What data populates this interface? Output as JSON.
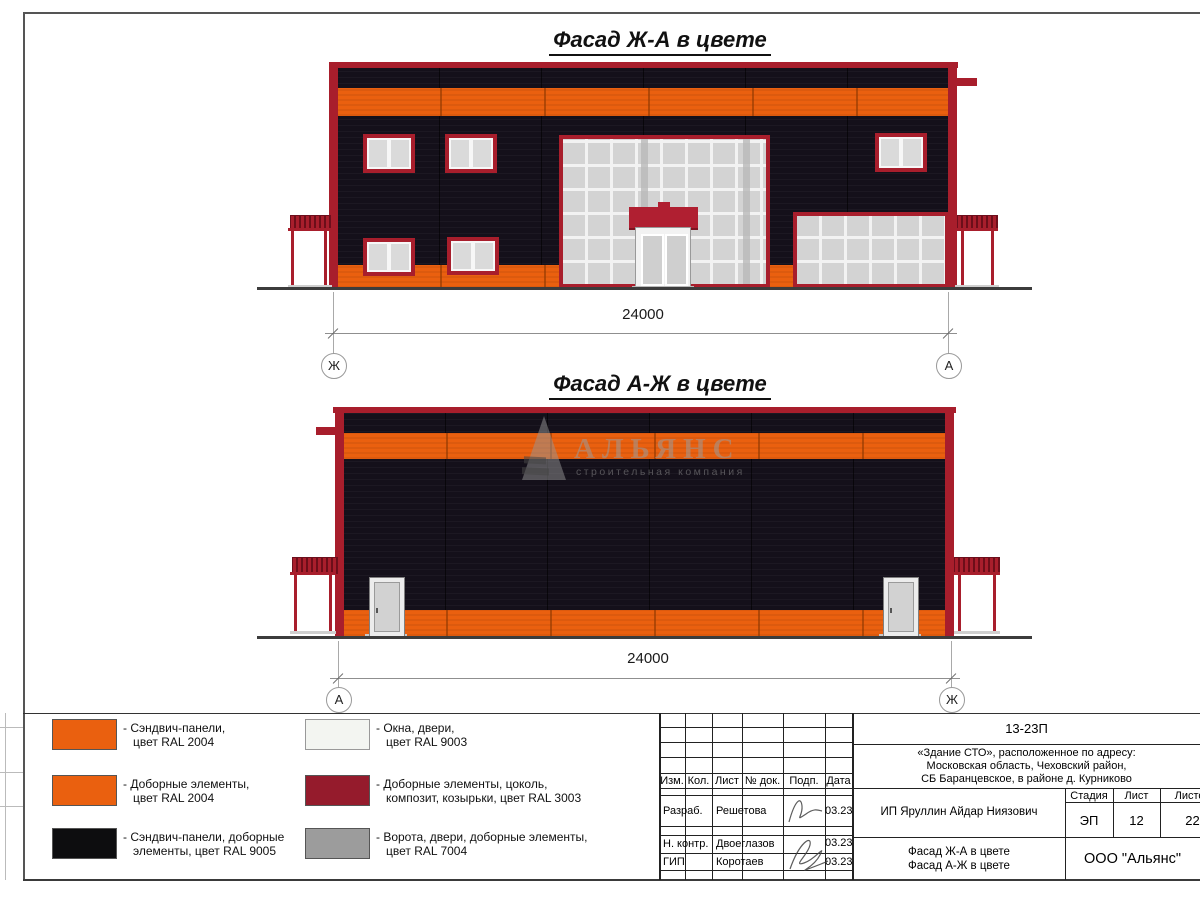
{
  "colors": {
    "orange": "#EA600F",
    "red": "#A81E2C",
    "canopyred": "#B01F31",
    "black": "#14101A",
    "glass": "#D3D3D3",
    "doorgray": "#D2D2D2",
    "ground": "#3C3C3C"
  },
  "facade1": {
    "title": "Фасад Ж-А в цвете",
    "dim": "24000",
    "axis_left": "Ж",
    "axis_right": "А"
  },
  "facade2": {
    "title": "Фасад А-Ж в цвете",
    "dim": "24000",
    "axis_left": "А",
    "axis_right": "Ж"
  },
  "watermark": {
    "brand": "АЛЬЯНС",
    "tagline": "строительная компания"
  },
  "legend": {
    "items": [
      {
        "color": "#EA600F",
        "line1": "- Сэндвич-панели,",
        "line2": "цвет RAL 2004"
      },
      {
        "color": "#EA600F",
        "line1": "- Доборные элементы,",
        "line2": "цвет RAL 2004"
      },
      {
        "color": "#0D0D0F",
        "line1": "- Сэндвич-панели, доборные",
        "line2": "элементы, цвет RAL 9005"
      },
      {
        "color": "#F3F5F1",
        "line1": "- Окна, двери,",
        "line2": "цвет RAL 9003"
      },
      {
        "color": "#951B2C",
        "line1": "- Доборные элементы, цоколь,",
        "line2": "композит, козырьки, цвет RAL 3003"
      },
      {
        "color": "#9C9C9C",
        "line1": "- Ворота, двери, доборные элементы,",
        "line2": "цвет RAL 7004"
      }
    ]
  },
  "titleblock": {
    "doc_number": "13-23П",
    "address1": "«Здание СТО», расположенное по адресу:",
    "address2": "Московская область, Чеховский район,",
    "address3": "СБ Баранцевское, в районе д. Курниково",
    "col_izm": "Изм.",
    "col_kol": "Кол.",
    "col_list": "Лист",
    "col_doc": "№ док.",
    "col_sign": "Подп.",
    "col_date": "Дата",
    "row1_role": "Разраб.",
    "row1_name": "Решетова",
    "row1_date": "03.23",
    "row2_role": "Н. контр.",
    "row2_name": "Двоеглазов",
    "row2_date": "03.23",
    "row3_role": "ГИП",
    "row3_name": "Коротаев",
    "row3_date": "03.23",
    "client": "ИП Яруллин Айдар Ниязович",
    "stage_label": "Стадия",
    "list_label": "Лист",
    "listov_label": "Листов",
    "stage": "ЭП",
    "list_no": "12",
    "listov": "22",
    "subject1": "Фасад Ж-А в цвете",
    "subject2": "Фасад А-Ж в цвете",
    "company": "ООО \"Альянс\""
  }
}
